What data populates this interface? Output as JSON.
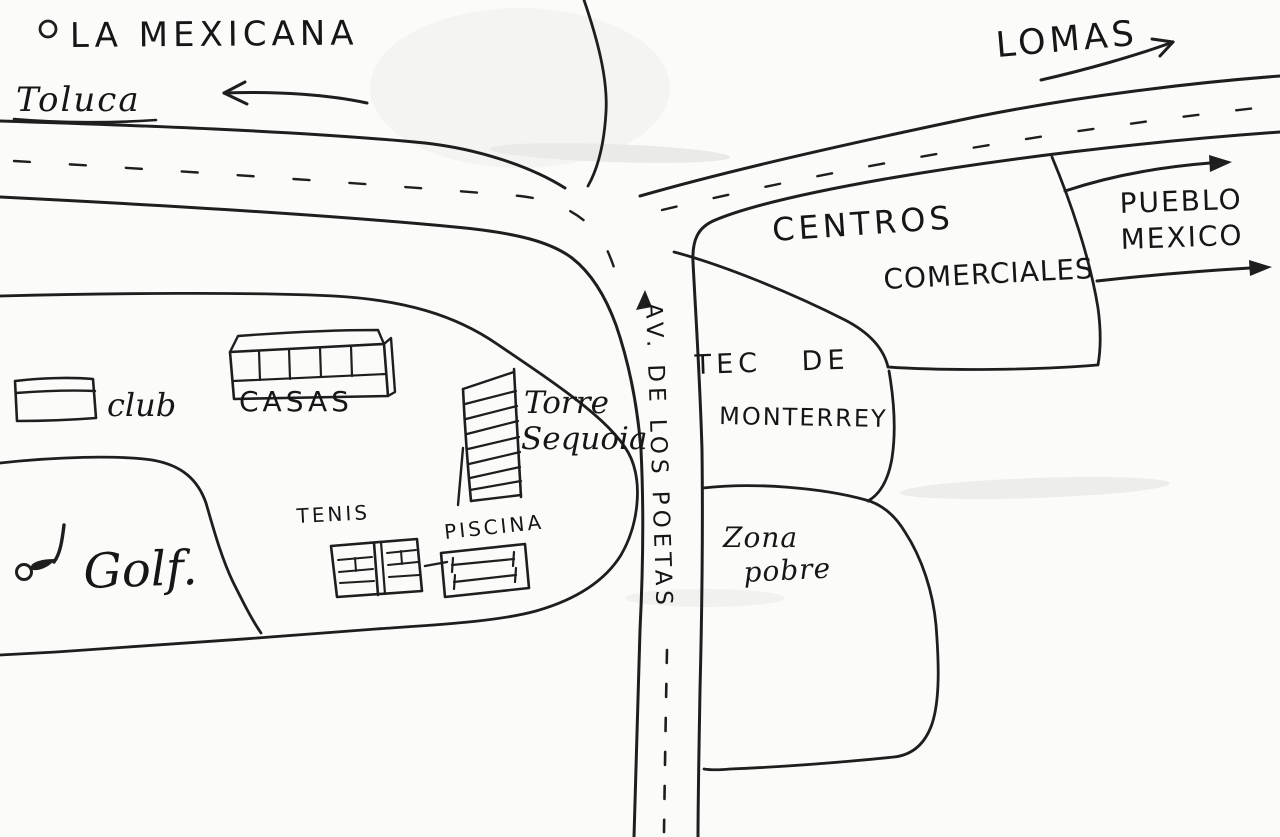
{
  "map": {
    "title": "Hand-drawn neighborhood sketch map",
    "paper_color": "#fbfbfa",
    "ink_color": "#1e1e1e",
    "destinations": {
      "toluca": {
        "label": "Toluca",
        "direction": "west"
      },
      "lomas": {
        "label": "LOMAS",
        "direction": "east"
      },
      "pueblo_mexico": {
        "line1": "PUEBLO",
        "line2": "MEXICO",
        "direction": "east"
      }
    },
    "roads": {
      "avenue": {
        "label": "AV. DE LOS POETAS"
      }
    },
    "areas": {
      "la_mexicana": {
        "label": "LA MEXICANA"
      },
      "centros_comerciales": {
        "line1": "CENTROS",
        "line2": "COMERCIALES"
      },
      "tec_de_monterrey": {
        "line1": "TEC DE",
        "line2": "MONTERREY"
      },
      "zona_pobre": {
        "line1": "Zona",
        "line2": "pobre"
      }
    },
    "places": {
      "club": {
        "label": "club"
      },
      "casas": {
        "label": "CASAS"
      },
      "torre_sequoia": {
        "line1": "Torre",
        "line2": "Sequoia"
      },
      "tenis": {
        "label": "TENIS"
      },
      "piscina": {
        "label": "PISCINA"
      },
      "golf": {
        "label": "Golf."
      }
    }
  }
}
